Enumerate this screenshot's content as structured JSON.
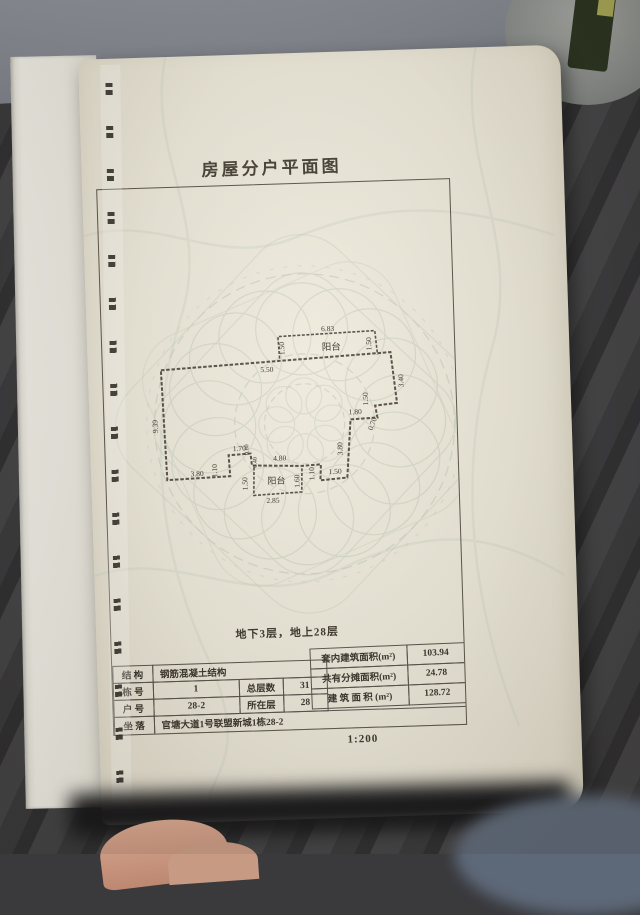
{
  "colors": {
    "page": "#eae6d8",
    "floor": "#3a3a3d",
    "watermark": "#b9c6b2",
    "ink": "#3b362f",
    "skin": "#cf9d89",
    "denim": "#5d6878"
  },
  "title": "房屋分户平面图",
  "floors_note": "地下3层，地上28层",
  "scale_label": "1:200",
  "plan": {
    "balcony_top": "阳台",
    "balcony_bottom": "阳台",
    "dims": {
      "top_width": "6.83",
      "bt_left": "1.50",
      "bt_right": "1.50",
      "top_edge": "5.50",
      "right_upper": "3.40",
      "right_notch": "1.50",
      "right_step_h": "1.80",
      "right_step_v": "0.70",
      "right_lower": "3.80",
      "br_edge": "1.50",
      "br_step": "1.10",
      "left_wall": "9.39",
      "bottom_left": "3.80",
      "bl_step": "1.10",
      "ledge": "1.70",
      "jog_a": "0.60",
      "jog_b": "0.40",
      "bottom_mid": "4.80",
      "bb_left": "1.50",
      "bb_width": "2.85",
      "bb_right": "1.60"
    }
  },
  "table": {
    "structure_label": "结 构",
    "structure_value": "钢筋混凝土结构",
    "building_no_label": "栋 号",
    "building_no": "1",
    "total_floors_label": "总层数",
    "total_floors": "31",
    "unit_no_label": "户 号",
    "unit_no": "28-2",
    "floor_label": "所在层",
    "floor": "28",
    "location_label": "坐 落",
    "location": "官塘大道1号联盟新城1栋28-2",
    "inner_area_label": "套内建筑面积(m²)",
    "inner_area": "103.94",
    "shared_area_label": "共有分摊面积(m²)",
    "shared_area": "24.78",
    "total_area_label": "建 筑 面 积 (m²)",
    "total_area": "128.72"
  }
}
